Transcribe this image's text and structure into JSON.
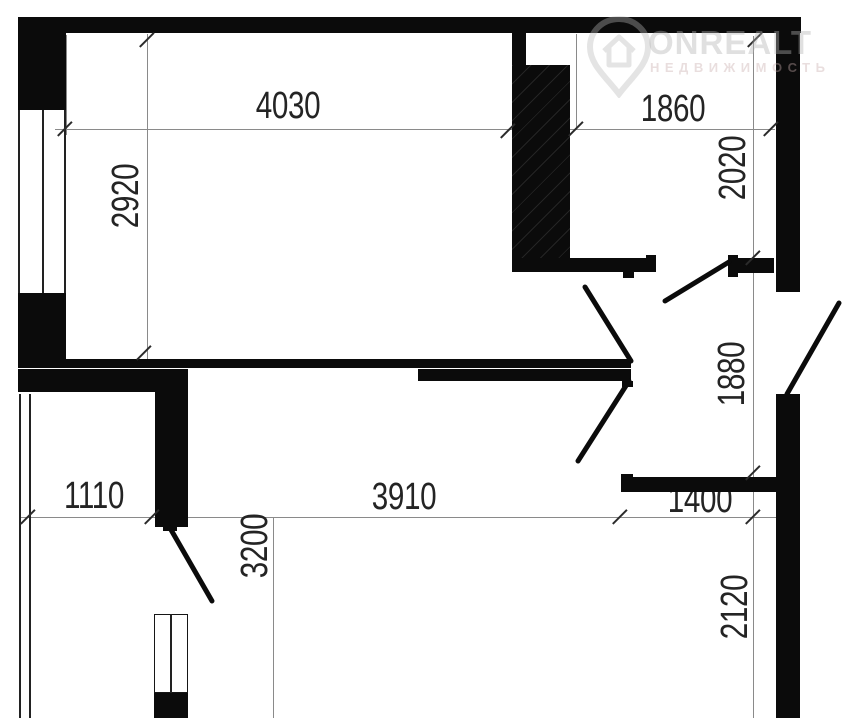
{
  "plan": {
    "type": "apartment-floor-plan",
    "watermark": {
      "brand": "ONREALT",
      "tagline": "НЕДВИЖИМОСТЬ"
    },
    "labels": [
      {
        "id": "top-room-width",
        "text": "4030",
        "orientation": "horizontal"
      },
      {
        "id": "top-right-room-width",
        "text": "1860",
        "orientation": "horizontal"
      },
      {
        "id": "top-room-height",
        "text": "2920",
        "orientation": "vertical"
      },
      {
        "id": "top-right-room-height",
        "text": "2020",
        "orientation": "vertical"
      },
      {
        "id": "hall-height",
        "text": "1880",
        "orientation": "vertical"
      },
      {
        "id": "bottom-left-width",
        "text": "1110",
        "orientation": "horizontal"
      },
      {
        "id": "bottom-room-width",
        "text": "3910",
        "orientation": "horizontal"
      },
      {
        "id": "bottom-right-width",
        "text": "1400",
        "orientation": "horizontal"
      },
      {
        "id": "bottom-left-height",
        "text": "3200",
        "orientation": "vertical"
      },
      {
        "id": "bottom-right-height",
        "text": "2120",
        "orientation": "vertical"
      }
    ],
    "colors": {
      "wall": "#0b0b0b",
      "dimension_line": "#8a8a8a",
      "dimension_text": "#242424",
      "watermark": "#b2b2b2"
    }
  }
}
